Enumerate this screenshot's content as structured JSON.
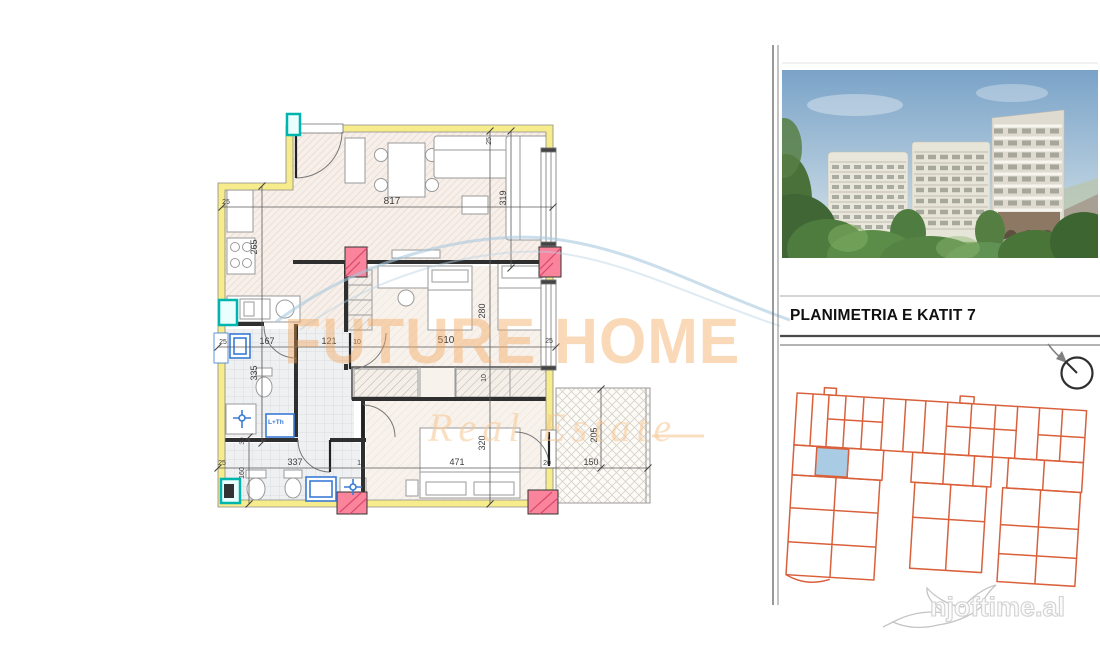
{
  "title": "PLANIMETRIA E KATIT 7",
  "watermark": {
    "brand": "FUTURE HOME",
    "tagline": "Real Estate"
  },
  "footer_logo": {
    "text": "njoftime.al"
  },
  "floor_plan": {
    "appliance_label": "L+Th",
    "colors": {
      "exterior_wall": "#f6ec8c",
      "column": "#f9849c",
      "fixture_blue": "#3a7bd5",
      "utility_teal": "#00b5ad"
    },
    "dim_lines": [
      {
        "x1": 222,
        "y1": 207,
        "x2": 553,
        "y2": 207
      },
      {
        "x1": 218,
        "y1": 347,
        "x2": 556,
        "y2": 347
      },
      {
        "x1": 218,
        "y1": 468,
        "x2": 648,
        "y2": 468
      },
      {
        "x1": 511,
        "y1": 131,
        "x2": 511,
        "y2": 268
      },
      {
        "x1": 262,
        "y1": 186,
        "x2": 262,
        "y2": 443
      },
      {
        "x1": 249,
        "y1": 437,
        "x2": 249,
        "y2": 504
      },
      {
        "x1": 490,
        "y1": 131,
        "x2": 490,
        "y2": 504
      },
      {
        "x1": 601,
        "y1": 389,
        "x2": 601,
        "y2": 468
      }
    ],
    "dimensions": [
      {
        "t": "817",
        "x": 392,
        "y": 204,
        "r": 0,
        "s": 10
      },
      {
        "t": "25",
        "x": 226,
        "y": 204,
        "r": 0,
        "s": 7
      },
      {
        "t": "319",
        "x": 506,
        "y": 198,
        "r": -90,
        "s": 9
      },
      {
        "t": "265",
        "x": 257,
        "y": 247,
        "r": -90,
        "s": 9
      },
      {
        "t": "25",
        "x": 223,
        "y": 344,
        "r": 0,
        "s": 7
      },
      {
        "t": "167",
        "x": 267,
        "y": 344,
        "r": 0,
        "s": 9
      },
      {
        "t": "121",
        "x": 329,
        "y": 344,
        "r": 0,
        "s": 9
      },
      {
        "t": "10",
        "x": 357,
        "y": 344,
        "r": 0,
        "s": 7
      },
      {
        "t": "510",
        "x": 446,
        "y": 343,
        "r": 0,
        "s": 10
      },
      {
        "t": "25",
        "x": 549,
        "y": 343,
        "r": 0,
        "s": 7
      },
      {
        "t": "280",
        "x": 485,
        "y": 311,
        "r": -90,
        "s": 9
      },
      {
        "t": "10",
        "x": 486,
        "y": 378,
        "r": -90,
        "s": 7
      },
      {
        "t": "320",
        "x": 485,
        "y": 443,
        "r": -90,
        "s": 9
      },
      {
        "t": "335",
        "x": 257,
        "y": 373,
        "r": -90,
        "s": 9
      },
      {
        "t": "30",
        "x": 244,
        "y": 441,
        "r": -90,
        "s": 6.5
      },
      {
        "t": "160",
        "x": 244,
        "y": 473,
        "r": -90,
        "s": 7
      },
      {
        "t": "25",
        "x": 222,
        "y": 465,
        "r": 0,
        "s": 7
      },
      {
        "t": "337",
        "x": 295,
        "y": 465,
        "r": 0,
        "s": 9
      },
      {
        "t": "10",
        "x": 361,
        "y": 465,
        "r": 0,
        "s": 7
      },
      {
        "t": "471",
        "x": 457,
        "y": 465,
        "r": 0,
        "s": 9
      },
      {
        "t": "20",
        "x": 547,
        "y": 465,
        "r": 0,
        "s": 7
      },
      {
        "t": "150",
        "x": 591,
        "y": 465,
        "r": 0,
        "s": 9
      },
      {
        "t": "205",
        "x": 597,
        "y": 435,
        "r": -90,
        "s": 9
      },
      {
        "t": "25",
        "x": 491,
        "y": 141,
        "r": -90,
        "s": 7
      }
    ]
  },
  "key_plan": {
    "outline_color": "#d9603a",
    "highlight_color": "#a9cbe3"
  }
}
